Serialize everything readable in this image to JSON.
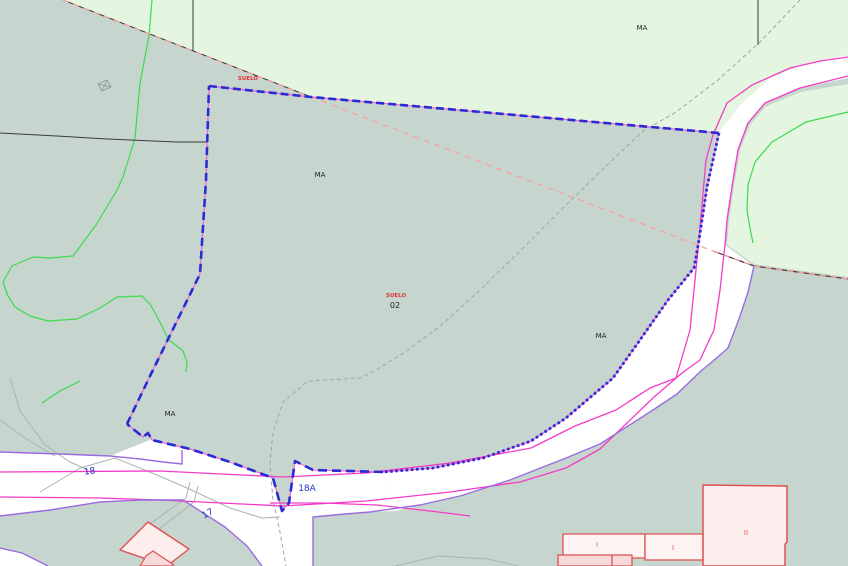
{
  "canvas": {
    "width": 848,
    "height": 566,
    "title": "cadastral-parcel-map"
  },
  "colors": {
    "ground": "#c6d6ce",
    "woodland_light": "#e4f6df",
    "road_fill": "#ffffff",
    "road_edge_violet": "#9b6ce0",
    "road_axis_magenta": "#f43bc8",
    "parcel_selected_blue": "#2b2bd4",
    "parcel_underlay_pink": "#f060d8",
    "boundary_black": "#3a3a3a",
    "boundary_salmon": "#ff9d9d",
    "contour_green": "#3bdb4e",
    "old_path_grey": "#9aa8a2",
    "building_outline": "#e05050",
    "building_fill": "#fdeeee",
    "building_fill_dark": "#f8d9d9",
    "label_black": "#1d1d1d",
    "label_red": "#e23333",
    "label_blue": "#2433cc",
    "label_building_red": "#e05b5b"
  },
  "layers": [
    {
      "name": "ground-base",
      "kind": "rect",
      "x": 0,
      "y": 0,
      "w": 848,
      "h": 566,
      "fill": "#c6d6ce",
      "interactable": false
    },
    {
      "name": "woodland-area-northwest",
      "kind": "polygon",
      "fill": "#e4f6df",
      "points": "63,0 311,97 719,133 722,128 740,105 770,78 810,62 848,55 848,0",
      "interactable": false
    },
    {
      "name": "woodland-area-east-of-road",
      "kind": "polygon",
      "fill": "#e4f6df",
      "points": "848,84 800,92 765,107 750,125 740,150 735,180 729,220 727,245 754,264 848,277",
      "interactable": false
    },
    {
      "name": "road-main-northeast",
      "kind": "polygon",
      "fill": "#ffffff",
      "points": "848,55 810,62 770,78 740,105 722,128 719,133 713,160 707,187 699,240 694,268 668,300 640,340 613,378 566,418 531,441 483,458 433,468 383,472 395,511 420,505 460,496 510,480 566,458 600,444 653,410 677,394 702,370 712,362 728,348 739,319 748,292 754,266 725,245 727,220 733,180 738,150 748,123 765,103 800,88 848,78",
      "interactable": false
    },
    {
      "name": "road-18-junction",
      "kind": "polygon",
      "fill": "#ffffff",
      "points": "0,452 60,454 110,456 152,439 190,449 230,461 272,477 282,511 289,503 295,460 313,469 383,472 395,511 370,512 345,514 313,517 313,566 262,566 247,546 225,527 183,500 140,500 100,502 50,510 0,516",
      "interactable": false
    },
    {
      "name": "road-corner-southwest",
      "kind": "polygon",
      "fill": "#ffffff",
      "points": "0,548 22,553 40,562 48,566 0,566",
      "interactable": false
    },
    {
      "name": "old-path-grey-long",
      "kind": "polyline",
      "stroke": "#9aa8a2",
      "width": 1,
      "dash": "4 3",
      "points": "800,0 760,42 718,80 676,112 643,131 600,172 566,205 518,253 478,292 438,328 405,352 373,372 360,378 308,381 283,402 273,432 270,465 273,500 280,532 286,566",
      "interactable": false
    },
    {
      "name": "old-path-grey-west-a",
      "kind": "polyline",
      "stroke": "#a8b4ae",
      "width": 1,
      "points": "10,378 20,411 45,445 70,462 88,470",
      "interactable": false
    },
    {
      "name": "old-path-grey-west-b",
      "kind": "polyline",
      "stroke": "#a8b4ae",
      "width": 1,
      "points": "0,420 28,440 55,456",
      "interactable": false
    },
    {
      "name": "old-road-edge-grey",
      "kind": "polyline",
      "stroke": "#a8b4ae",
      "width": 1,
      "points": "40,492 80,468 115,458 157,475 187,488 230,508 262,518 280,517",
      "interactable": false
    },
    {
      "name": "old-road-arc-bottom",
      "kind": "polyline",
      "stroke": "#a8b4ae",
      "width": 1,
      "points": "395,566 438,556 488,559 518,566",
      "interactable": false
    },
    {
      "name": "driveway-grey-a",
      "kind": "polyline",
      "stroke": "#a8b4ae",
      "width": 1,
      "points": "150,524 186,498 190,482",
      "interactable": false
    },
    {
      "name": "driveway-grey-b",
      "kind": "polyline",
      "stroke": "#a8b4ae",
      "width": 1,
      "points": "158,530 194,502 198,486",
      "interactable": false
    },
    {
      "name": "contour-green-west",
      "kind": "polyline",
      "stroke": "#3bdb4e",
      "width": 1.2,
      "points": "152,0 149,36 140,83 135,138 123,177 117,190 96,225 73,256 50,258 33,257 12,266 3,282 8,296 15,307 30,316 48,321 77,319 100,308 117,297 142,296 150,304 160,322 168,339 183,351 187,362 186,372",
      "interactable": false
    },
    {
      "name": "contour-green-southwest",
      "kind": "polyline",
      "stroke": "#3bdb4e",
      "width": 1.2,
      "points": "80,381 60,391 42,403",
      "interactable": false
    },
    {
      "name": "contour-green-northeast",
      "kind": "polyline",
      "stroke": "#3bdb4e",
      "width": 1.2,
      "points": "848,112 806,122 772,142 755,162 748,185 747,210 750,228 753,243",
      "interactable": false
    },
    {
      "name": "parcel-line-black-horizontal",
      "kind": "polyline",
      "stroke": "#3a3a3a",
      "width": 1,
      "points": "0,133 57,136 107,139 177,142 208,142",
      "interactable": false
    },
    {
      "name": "parcel-line-black-vertical-a",
      "kind": "polyline",
      "stroke": "#3a3a3a",
      "width": 1,
      "points": "193,0 193,51",
      "interactable": false
    },
    {
      "name": "parcel-line-black-vertical-b",
      "kind": "polyline",
      "stroke": "#3a3a3a",
      "width": 1,
      "points": "758,0 758,45",
      "interactable": false
    },
    {
      "name": "boundary-diagonal-black",
      "kind": "polyline",
      "stroke": "#3a3a3a",
      "width": 1,
      "points": "63,0 311,97",
      "interactable": false
    },
    {
      "name": "boundary-diagonal-salmon",
      "kind": "polyline",
      "stroke": "#ff9d9d",
      "width": 1.2,
      "dash": "6 5",
      "points": "63,0 311,97",
      "interactable": false
    },
    {
      "name": "boundary-salmon-dashed-cross",
      "kind": "polyline",
      "stroke": "#ff9d9d",
      "width": 1.2,
      "dash": "6 5",
      "points": "311,97 713,251",
      "interactable": false
    },
    {
      "name": "boundary-east-black",
      "kind": "polyline",
      "stroke": "#4a3a3a",
      "width": 1.2,
      "points": "713,251 754,266 848,279",
      "interactable": false
    },
    {
      "name": "boundary-east-salmon",
      "kind": "polyline",
      "stroke": "#ff9d9d",
      "width": 1.2,
      "dash": "6 5",
      "points": "713,251 754,266 848,279",
      "interactable": false
    },
    {
      "name": "road-axis-magenta-north",
      "kind": "polyline",
      "stroke": "#f43bc8",
      "width": 1.3,
      "points": "0,472 160,471 283,477 366,473 450,463 531,448 575,426 616,410 650,388 676,378 690,330 698,250 706,160 713,135 727,103 752,85 790,68 820,61 848,57",
      "interactable": false
    },
    {
      "name": "road-axis-magenta-south",
      "kind": "polyline",
      "stroke": "#f43bc8",
      "width": 1.3,
      "points": "0,497 100,498 160,500 283,506 366,501 450,492 520,482 566,468 600,449 653,398 682,373 700,360 714,330 720,290 725,245 727,220 733,180 738,150 748,123 765,103 800,88 848,76",
      "interactable": false
    },
    {
      "name": "road-axis-magenta-short",
      "kind": "polyline",
      "stroke": "#f43bc8",
      "width": 1.2,
      "points": "270,503 323,503 377,505 430,511 470,516",
      "interactable": false
    },
    {
      "name": "road-edge-violet-southeast",
      "kind": "polyline",
      "stroke": "#9b6ce0",
      "width": 1.4,
      "points": "754,266 748,292 739,319 728,348 712,362 702,370 677,394 653,410 600,444 566,458 510,480 460,496 420,505 370,512 345,514 313,517 313,566",
      "interactable": false
    },
    {
      "name": "road-edge-violet-north18",
      "kind": "polyline",
      "stroke": "#9b6ce0",
      "width": 1.4,
      "points": "0,452 60,454 110,456 140,459 163,462 182,464 182,450",
      "interactable": false
    },
    {
      "name": "road-edge-violet-south18",
      "kind": "polyline",
      "stroke": "#9b6ce0",
      "width": 1.4,
      "points": "0,516 50,510 100,502 140,500 183,500 225,527 247,546 262,566",
      "interactable": false
    },
    {
      "name": "road-edge-violet-corner",
      "kind": "polyline",
      "stroke": "#9b6ce0",
      "width": 1.4,
      "points": "0,548 22,553 40,562 48,566",
      "interactable": false
    },
    {
      "name": "parcel-boundary-underlay-pink",
      "kind": "polygon",
      "fill": "none",
      "stroke": "#f060d8",
      "width": 1.2,
      "points": "209,86 311,97 719,133 713,160 707,187 699,240 694,268 668,300 640,340 613,378 566,418 531,441 483,458 433,468 383,472 313,470 295,461 289,503 282,511 273,478 230,462 190,449 152,440 148,433 143,437 127,424 151,374 200,274 206,180",
      "interactable": true
    },
    {
      "name": "parcel-boundary-top",
      "kind": "polyline",
      "stroke": "#2b2bd4",
      "width": 2.6,
      "dash": "8 4",
      "points": "209,86 311,97 719,133",
      "interactable": true
    },
    {
      "name": "parcel-boundary-east-dotted",
      "kind": "polyline",
      "stroke": "#2b2bd4",
      "width": 2.8,
      "dash": "2.6 2.6",
      "points": "719,133 713,160 707,187 699,240 694,268 668,300 640,340 613,378 566,418 531,441 483,458 433,468 383,472",
      "interactable": true
    },
    {
      "name": "parcel-boundary-south-zigzag",
      "kind": "polyline",
      "stroke": "#2b2bd4",
      "width": 2.6,
      "dash": "9 5",
      "points": "383,472 313,470 295,461 289,503 282,511 273,478 230,462 190,449 152,440 148,433 143,437 127,424",
      "interactable": true
    },
    {
      "name": "parcel-boundary-west",
      "kind": "polyline",
      "stroke": "#2b2bd4",
      "width": 2.6,
      "dash": "8 5",
      "points": "127,424 151,374 200,274 206,180 209,86",
      "interactable": true
    },
    {
      "name": "building-farm-outer",
      "kind": "polygon",
      "fill": "#fdeeee",
      "stroke": "#e05050",
      "width": 1.4,
      "points": "148,522 189,549 167,566 120,550",
      "interactable": false
    },
    {
      "name": "building-farm-inner",
      "kind": "polygon",
      "fill": "#f8d9d9",
      "stroke": "#e05050",
      "width": 1.2,
      "points": "153,551 174,565 172,566 140,566 146,556",
      "interactable": false
    },
    {
      "name": "building-row-a",
      "kind": "polygon",
      "fill": "#fdf3f3",
      "stroke": "#e05050",
      "width": 1.3,
      "points": "563,534 645,534 645,558 563,558",
      "interactable": false
    },
    {
      "name": "building-row-b",
      "kind": "polygon",
      "fill": "#fdf3f3",
      "stroke": "#e05050",
      "width": 1.3,
      "points": "645,534 703,534 703,560 645,560",
      "interactable": false
    },
    {
      "name": "building-row-front",
      "kind": "polygon",
      "fill": "#f8d9d9",
      "stroke": "#e05050",
      "width": 1.3,
      "points": "558,555 632,555 632,566 558,566",
      "interactable": false
    },
    {
      "name": "building-row-front-divider",
      "kind": "polyline",
      "stroke": "#e05050",
      "width": 1.3,
      "points": "612,555 612,566",
      "interactable": false
    },
    {
      "name": "building-two-storey",
      "kind": "polygon",
      "fill": "#fdeeee",
      "stroke": "#e05050",
      "width": 1.5,
      "points": "703,485 787,486 787,542 785,544 785,566 703,566",
      "interactable": false
    },
    {
      "name": "ruin-symbol",
      "kind": "polygon",
      "fill": "none",
      "stroke": "#8f9e98",
      "width": 0.9,
      "points": "98,84 107,80 111,87 102,91",
      "interactable": false
    },
    {
      "name": "ruin-symbol-diag-a",
      "kind": "polyline",
      "stroke": "#8f9e98",
      "width": 0.9,
      "points": "98,84 111,87",
      "interactable": false
    },
    {
      "name": "ruin-symbol-diag-b",
      "kind": "polyline",
      "stroke": "#8f9e98",
      "width": 0.9,
      "points": "107,80 102,91",
      "interactable": false
    }
  ],
  "labels": [
    {
      "name": "label-suelo-north",
      "text": "SUELO",
      "x": 248,
      "y": 80,
      "color": "#e23333",
      "size": 5.5,
      "bold": true,
      "rotate": 0
    },
    {
      "name": "label-ma-parcel-west",
      "text": "MA",
      "x": 320,
      "y": 177,
      "color": "#1d1d1d",
      "size": 7,
      "bold": false,
      "rotate": 0
    },
    {
      "name": "label-ma-woodland",
      "text": "MA",
      "x": 642,
      "y": 30,
      "color": "#1d1d1d",
      "size": 7,
      "bold": false,
      "rotate": 0
    },
    {
      "name": "label-suelo-center",
      "text": "SUELO",
      "x": 396,
      "y": 297,
      "color": "#e23333",
      "size": 5.5,
      "bold": true,
      "rotate": 0
    },
    {
      "name": "label-parcel-number-02",
      "text": "02",
      "x": 395,
      "y": 308,
      "color": "#1d1d1d",
      "size": 8,
      "bold": false,
      "rotate": 0
    },
    {
      "name": "label-ma-parcel-east",
      "text": "MA",
      "x": 601,
      "y": 338,
      "color": "#1d1d1d",
      "size": 7,
      "bold": false,
      "rotate": 0
    },
    {
      "name": "label-ma-parcel-south",
      "text": "MA",
      "x": 170,
      "y": 416,
      "color": "#1d1d1d",
      "size": 7,
      "bold": false,
      "rotate": 0
    },
    {
      "name": "label-road-18",
      "text": "18",
      "x": 90,
      "y": 474,
      "color": "#2433cc",
      "size": 9,
      "bold": false,
      "rotate": -8
    },
    {
      "name": "label-road-18a",
      "text": "18A",
      "x": 307,
      "y": 491,
      "color": "#2433cc",
      "size": 9,
      "bold": false,
      "rotate": 0
    },
    {
      "name": "label-road-17",
      "text": "17",
      "x": 209,
      "y": 516,
      "color": "#2433cc",
      "size": 9,
      "bold": false,
      "rotate": -28
    },
    {
      "name": "label-building-i-a",
      "text": "I",
      "x": 597,
      "y": 547,
      "color": "#e05b5b",
      "size": 7,
      "bold": false,
      "rotate": 0
    },
    {
      "name": "label-building-i-b",
      "text": "I",
      "x": 673,
      "y": 550,
      "color": "#e05b5b",
      "size": 7,
      "bold": false,
      "rotate": 0
    },
    {
      "name": "label-building-ii",
      "text": "II",
      "x": 746,
      "y": 535,
      "color": "#e05b5b",
      "size": 7,
      "bold": false,
      "rotate": 0
    }
  ]
}
